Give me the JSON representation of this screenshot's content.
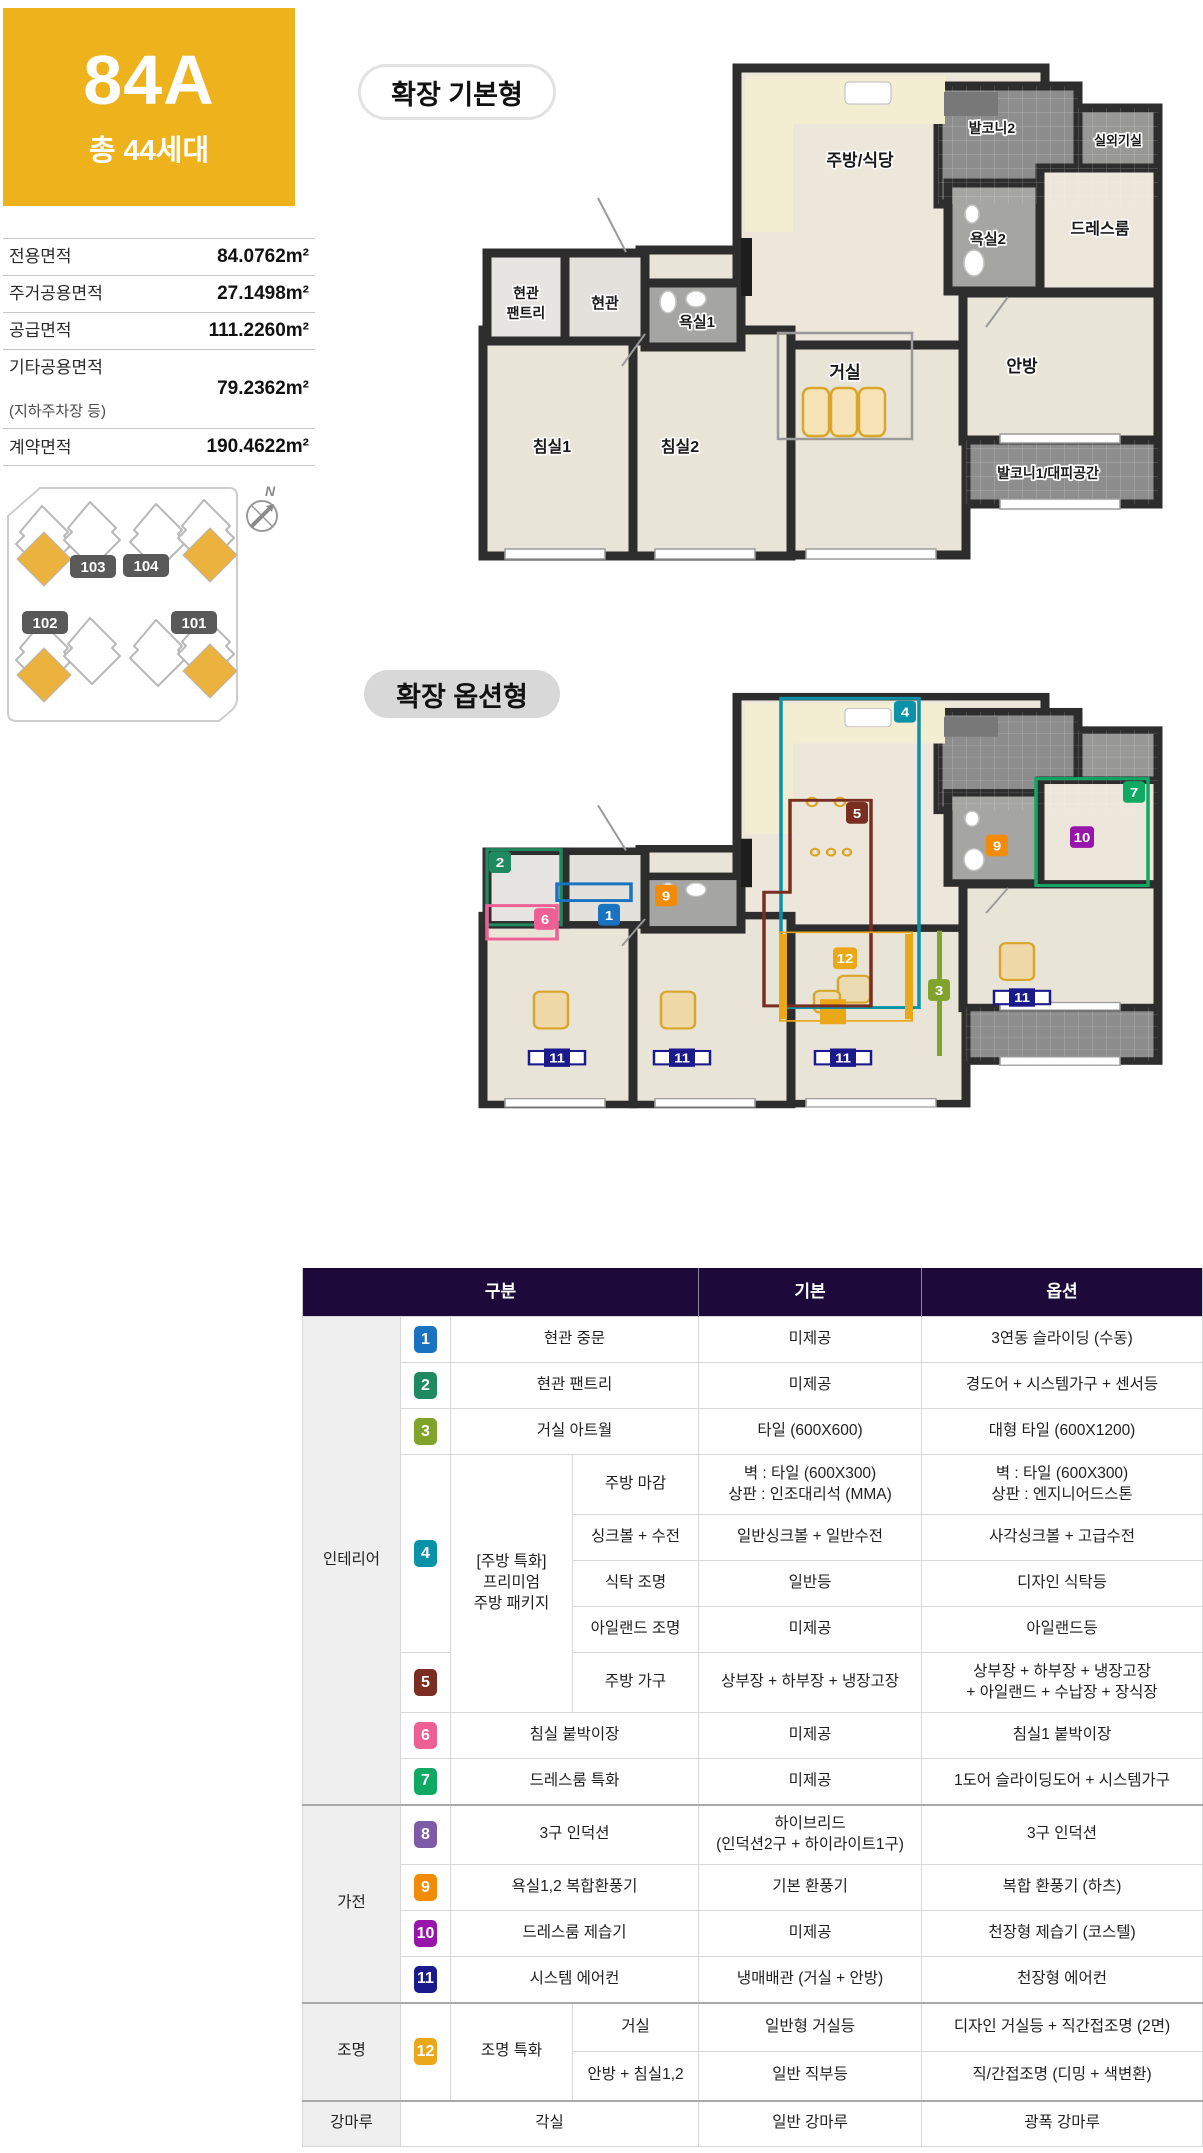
{
  "unit": {
    "code": "84A",
    "total": "총 44세대"
  },
  "colors": {
    "brand_yellow": "#eeb21c",
    "header_bg": "#1e0a3a",
    "map_unit_fill": "#ecb23e",
    "map_badge_bg": "#595959",
    "wall": "#2d2d2d"
  },
  "area_table": {
    "rows": [
      {
        "label": "전용면적",
        "value": "84.0762m²"
      },
      {
        "label": "주거공용면적",
        "value": "27.1498m²"
      },
      {
        "label": "공급면적",
        "value": "111.2260m²"
      },
      {
        "label": "기타공용면적",
        "label2": "(지하주차장 등)",
        "value": "79.2362m²"
      },
      {
        "label": "계약면적",
        "value": "190.4622m²"
      }
    ]
  },
  "sitemap": {
    "labels": [
      "103",
      "104",
      "102",
      "101"
    ],
    "north": "N"
  },
  "plan_basic": {
    "title": "확장 기본형",
    "labels": {
      "kitchen": "주방/식당",
      "balcony2": "발코니2",
      "outdoor_unit": "실외기실",
      "entry_pantry_line1": "현관",
      "entry_pantry_line2": "팬트리",
      "entry": "현관",
      "bath1": "욕실1",
      "bath2": "욕실2",
      "dress": "드레스룸",
      "living": "거실",
      "master": "안방",
      "bed1": "침실1",
      "bed2": "침실2",
      "balcony1": "발코니1/대피공간"
    }
  },
  "plan_option": {
    "title": "확장 옵션형"
  },
  "options_table": {
    "col_headers": [
      "구분",
      "기본",
      "옵션"
    ],
    "category_labels": {
      "interior": "인테리어",
      "appliance": "가전",
      "lighting": "조명",
      "flooring": "강마루"
    },
    "items": [
      {
        "no": "1",
        "color": "#1a73c0",
        "label": "현관 중문",
        "base": "미제공",
        "option": "3연동 슬라이딩 (수동)"
      },
      {
        "no": "2",
        "color": "#1f8a5f",
        "label": "현관 팬트리",
        "base": "미제공",
        "option": "경도어 + 시스템가구 + 센서등"
      },
      {
        "no": "3",
        "color": "#7fa32b",
        "label": "거실 아트월",
        "base": "타일 (600X600)",
        "option": "대형 타일 (600X1200)"
      },
      {
        "no": "4",
        "color": "#0a93a8",
        "group": "[주방 특화]\n프리미엄\n주방 패키지",
        "subs": [
          {
            "label": "주방 마감",
            "base": "벽 : 타일 (600X300)\n상판 : 인조대리석 (MMA)",
            "option": "벽 : 타일 (600X300)\n상판 : 엔지니어드스톤"
          },
          {
            "label": "싱크볼 + 수전",
            "base": "일반싱크볼 + 일반수전",
            "option": "사각싱크볼 + 고급수전"
          },
          {
            "label": "식탁 조명",
            "base": "일반등",
            "option": "디자인 식탁등"
          },
          {
            "label": "아일랜드 조명",
            "base": "미제공",
            "option": "아일랜드등"
          }
        ]
      },
      {
        "no": "5",
        "color": "#7a2e22",
        "label": "주방 가구",
        "base": "상부장 + 하부장 + 냉장고장",
        "option": "상부장 + 하부장 + 냉장고장\n+ 아일랜드 + 수납장 + 장식장"
      },
      {
        "no": "6",
        "color": "#ee5f94",
        "label": "침실 붙박이장",
        "base": "미제공",
        "option": "침실1 붙박이장"
      },
      {
        "no": "7",
        "color": "#10a964",
        "label": "드레스룸 특화",
        "base": "미제공",
        "option": "1도어 슬라이딩도어 + 시스템가구"
      },
      {
        "no": "8",
        "color": "#7e5ba6",
        "label": "3구 인덕션",
        "base": "하이브리드\n(인덕션2구 + 하이라이트1구)",
        "option": "3구 인덕션"
      },
      {
        "no": "9",
        "color": "#f28b05",
        "label": "욕실1,2 복합환풍기",
        "base": "기본 환풍기",
        "option": "복합 환풍기 (하츠)"
      },
      {
        "no": "10",
        "color": "#9715a8",
        "label": "드레스룸 제습기",
        "base": "미제공",
        "option": "천장형 제습기 (코스텔)"
      },
      {
        "no": "11",
        "color": "#1b1a8c",
        "label": "시스템 에어컨",
        "base": "냉매배관 (거실 + 안방)",
        "option": "천장형 에어컨"
      },
      {
        "no": "12",
        "color": "#eaa818",
        "group": "조명 특화",
        "subs": [
          {
            "label": "거실",
            "base": "일반형 거실등",
            "option": "디자인 거실등 + 직간접조명 (2면)"
          },
          {
            "label": "안방 + 침실1,2",
            "base": "일반 직부등",
            "option": "직/간접조명 (디밍 + 색변환)"
          }
        ]
      }
    ],
    "flooring": {
      "label": "각실",
      "base": "일반 강마루",
      "option": "광폭 강마루"
    }
  }
}
